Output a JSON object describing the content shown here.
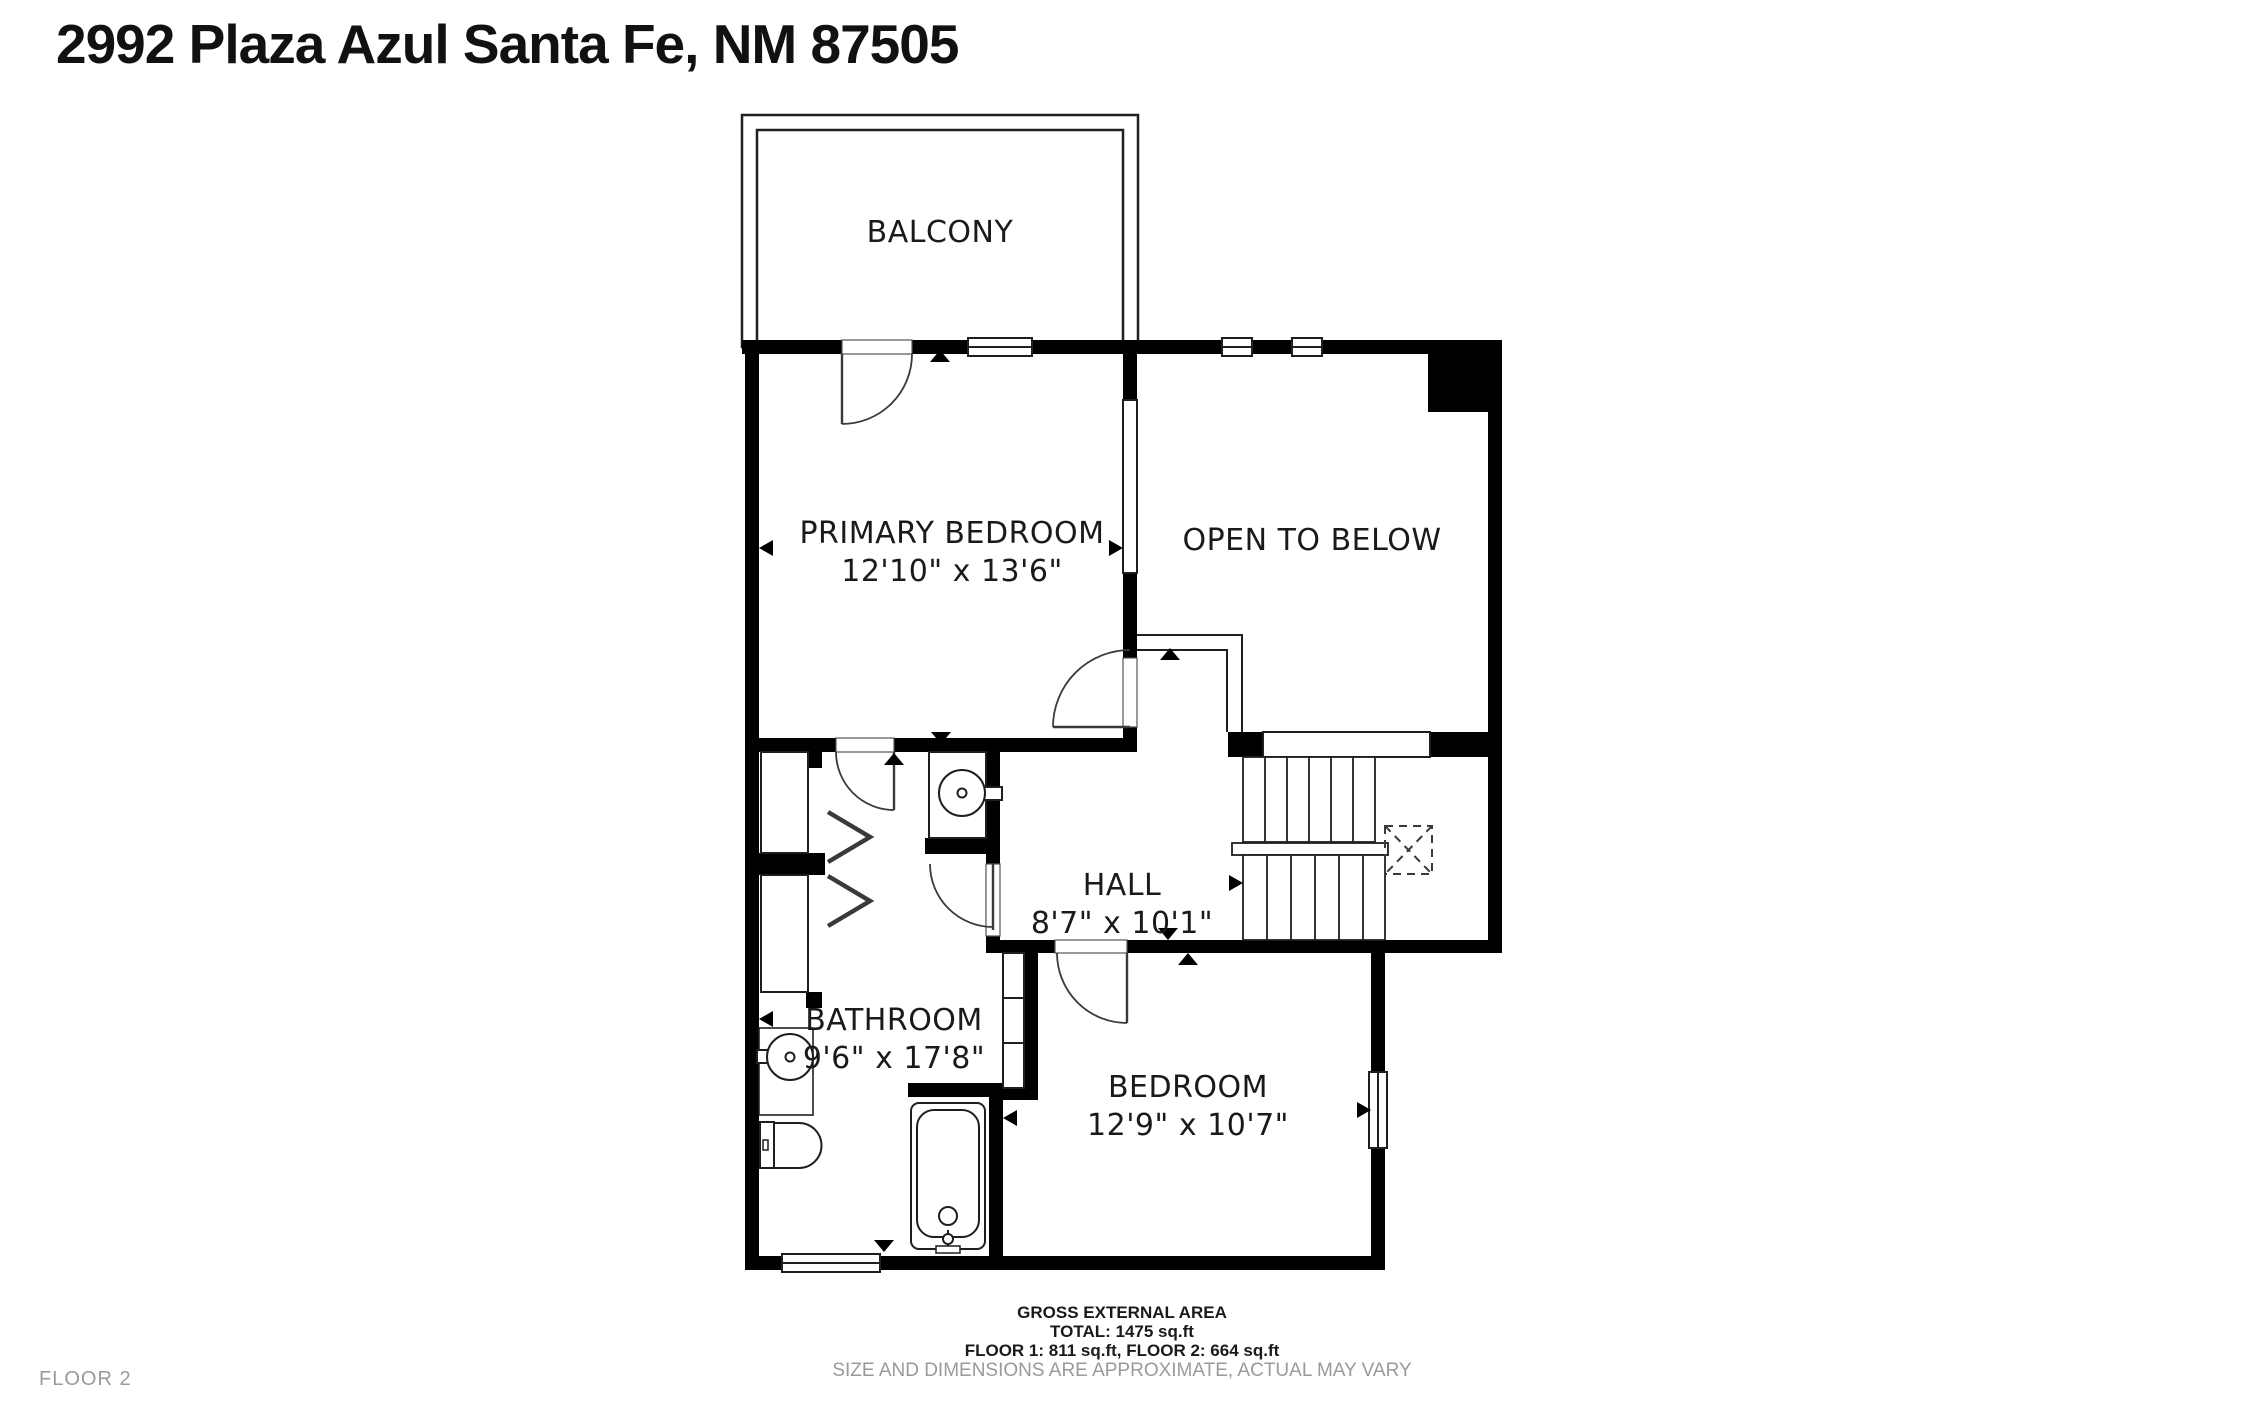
{
  "title": "2992 Plaza Azul Santa Fe, NM 87505",
  "floor_label": "FLOOR 2",
  "rooms": [
    {
      "id": "balcony",
      "name": "BALCONY",
      "dims": ""
    },
    {
      "id": "primary-bedroom",
      "name": "PRIMARY BEDROOM",
      "dims": "12'10\" x 13'6\""
    },
    {
      "id": "open-to-below",
      "name": "OPEN TO BELOW",
      "dims": ""
    },
    {
      "id": "hall",
      "name": "HALL",
      "dims": "8'7\" x 10'1\""
    },
    {
      "id": "bathroom",
      "name": "BATHROOM",
      "dims": "9'6\" x 17'8\""
    },
    {
      "id": "bedroom",
      "name": "BEDROOM",
      "dims": "12'9\" x 10'7\""
    }
  ],
  "summary": {
    "line1": "GROSS EXTERNAL AREA",
    "line2": "TOTAL: 1475 sq.ft",
    "line3": "FLOOR 1: 811 sq.ft, FLOOR 2: 664 sq.ft",
    "disclaimer": "SIZE AND DIMENSIONS ARE APPROXIMATE, ACTUAL MAY VARY"
  },
  "colors": {
    "wall": "#000000",
    "line": "#1f1f1f",
    "text": "#1a1a1a",
    "muted_text": "#9a9a9a"
  }
}
